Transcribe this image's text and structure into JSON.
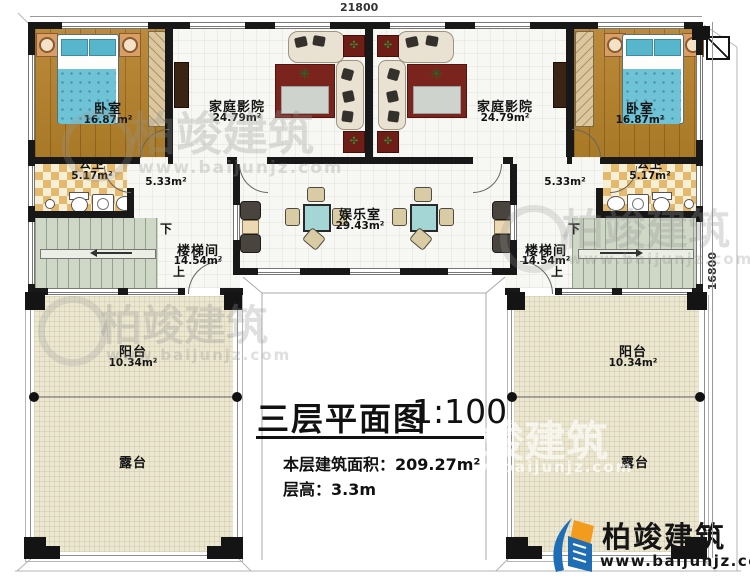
{
  "dimensions": {
    "top": "21800",
    "right": "16800"
  },
  "title_block": {
    "title": "三层平面图",
    "scale": "1:100",
    "area_label": "本层建筑面积：",
    "area_value": "209.27m²",
    "floor_height_label": "层高：",
    "floor_height_value": "3.3m"
  },
  "logo": {
    "brand": "柏竣建筑",
    "url": "www.baijunjz.com"
  },
  "watermark": {
    "brand": "柏竣建筑",
    "url": "www.baijunjz.com"
  },
  "stairs": {
    "up": "上",
    "down": "下"
  },
  "rooms": {
    "bedroom_left": {
      "name": "卧室",
      "area": "16.87m²"
    },
    "bedroom_right": {
      "name": "卧室",
      "area": "16.87m²"
    },
    "theater_left": {
      "name": "家庭影院",
      "area": "24.79m²"
    },
    "theater_right": {
      "name": "家庭影院",
      "area": "24.79m²"
    },
    "bath_left": {
      "name": "公卫",
      "area": "5.17m²"
    },
    "bath_right": {
      "name": "公卫",
      "area": "5.17m²"
    },
    "corridor_left": {
      "area": "5.33m²"
    },
    "corridor_right": {
      "area": "5.33m²"
    },
    "stair_left": {
      "name": "楼梯间",
      "area": "14.54m²"
    },
    "stair_right": {
      "name": "楼梯间",
      "area": "14.54m²"
    },
    "recreation": {
      "name": "娱乐室",
      "area": "29.43m²"
    },
    "balcony_left": {
      "name": "阳台",
      "area": "10.34m²"
    },
    "balcony_right": {
      "name": "阳台",
      "area": "10.34m²"
    },
    "terrace_left": {
      "name": "露台"
    },
    "terrace_right": {
      "name": "露台"
    }
  },
  "colors": {
    "wall": "#181818",
    "wood": "#b5832e",
    "bed": "#6fc3d6",
    "rug": "#7a241d",
    "deck": "#ece7d1",
    "brand_blue": "#1f6eb5",
    "brand_orange": "#f29b1d"
  }
}
